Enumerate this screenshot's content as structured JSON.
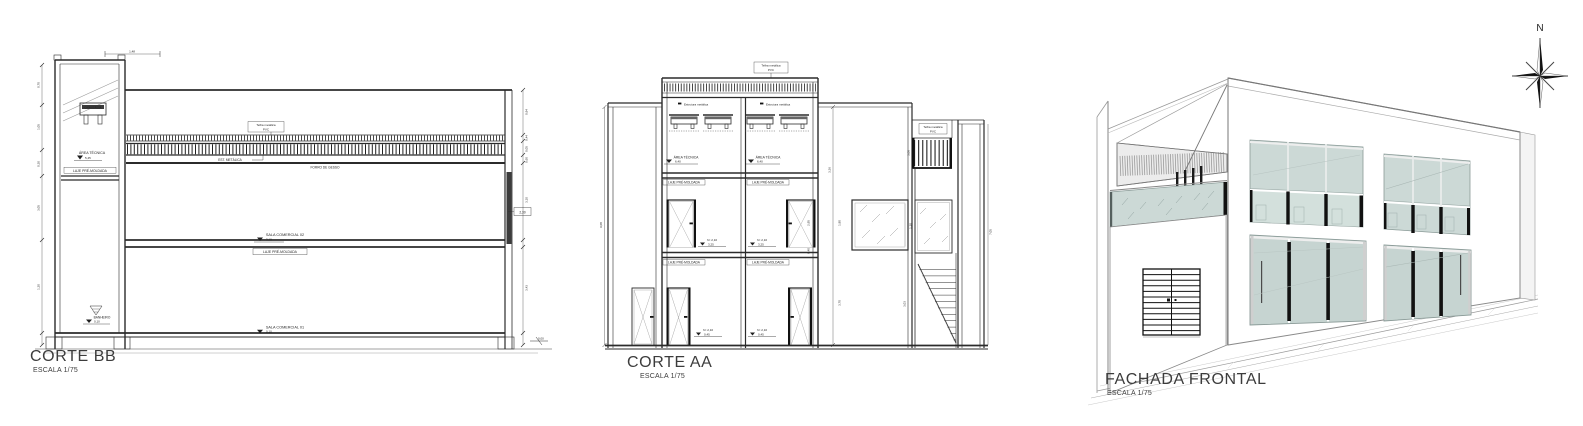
{
  "views": {
    "corte_bb": {
      "title": "CORTE BB",
      "scale": "ESCALA 1/75"
    },
    "corte_aa": {
      "title": "CORTE AA",
      "scale": "ESCALA 1/75"
    },
    "fachada": {
      "title": "FACHADA FRONTAL",
      "scale": "ESCALA 1/75"
    }
  },
  "compass": {
    "north": "N"
  },
  "colors": {
    "glass": "#ccd9d6",
    "storefront_glass": "#c6d4d1",
    "north_letter": "#3646bd",
    "line": "#2b2b2b"
  },
  "corte_bb": {
    "ann": {
      "dim_top": "1,48",
      "tank": "CAIXA D'ÁGUA",
      "telha1": "Telha metálica",
      "telha2": "PVC",
      "est": "EST. METÁLICA",
      "forro": "FORRO DE GESSO",
      "area": "ÁREA TÉCNICA",
      "area_lv": "5,45",
      "laje_t": "LAJE PRÉ-MOLDADA",
      "sala2": "SALA COMERCIAL 02",
      "sala2_lv": "3,10",
      "laje_m": "LAJE PRÉ-MOLDADA",
      "sala1": "SALA COMERCIAL 01",
      "sala1_lv": "0,10",
      "wc": "BANHEIRO",
      "wc_lv": "0,10",
      "tag": "2,30",
      "ground_lv": "0,00"
    },
    "dims_left": [
      "0,70",
      "1,05",
      "0,30",
      "3,05",
      "1,20"
    ],
    "dims_right": [
      "0,94",
      "0,44",
      "0,05",
      "0,60",
      "3,10",
      "3,43"
    ]
  },
  "corte_aa": {
    "ann": {
      "telha1": "Telha metálica",
      "telha2": "PVC",
      "estr_l": "Estrutura metálica",
      "estr_r": "Estrutura metálica",
      "area_l": "ÁREA TÉCNICA",
      "area_l_lv": "6,40",
      "area_r": "ÁREA TÉCNICA",
      "area_r_lv": "6,40",
      "laje1": "LAJE PRÉ-MOLDADA",
      "laje2": "LAJE PRÉ-MOLDADA",
      "laje3": "LAJE PRÉ-MOLDADA",
      "laje4": "LAJE PRÉ-MOLDADA",
      "du_l": "h= 2,10",
      "du_l_lv": "3,25",
      "du_r": "h= 2,10",
      "du_r_lv": "3,25",
      "dd_l": "h= 2,10",
      "dd_l_lv": "0,45",
      "dd_r": "h= 2,10",
      "dd_r_lv": "0,45",
      "telha_r1": "Telha metálica",
      "telha_r2": "PVC"
    },
    "dims": {
      "left": "9,08",
      "tower": "2,95",
      "mid": "3,36",
      "a": "1,80",
      "b": "3,70",
      "slab": "0,40",
      "rail": "3,08",
      "stair": "3,03",
      "right": "7,05",
      "win": "1,20"
    }
  }
}
